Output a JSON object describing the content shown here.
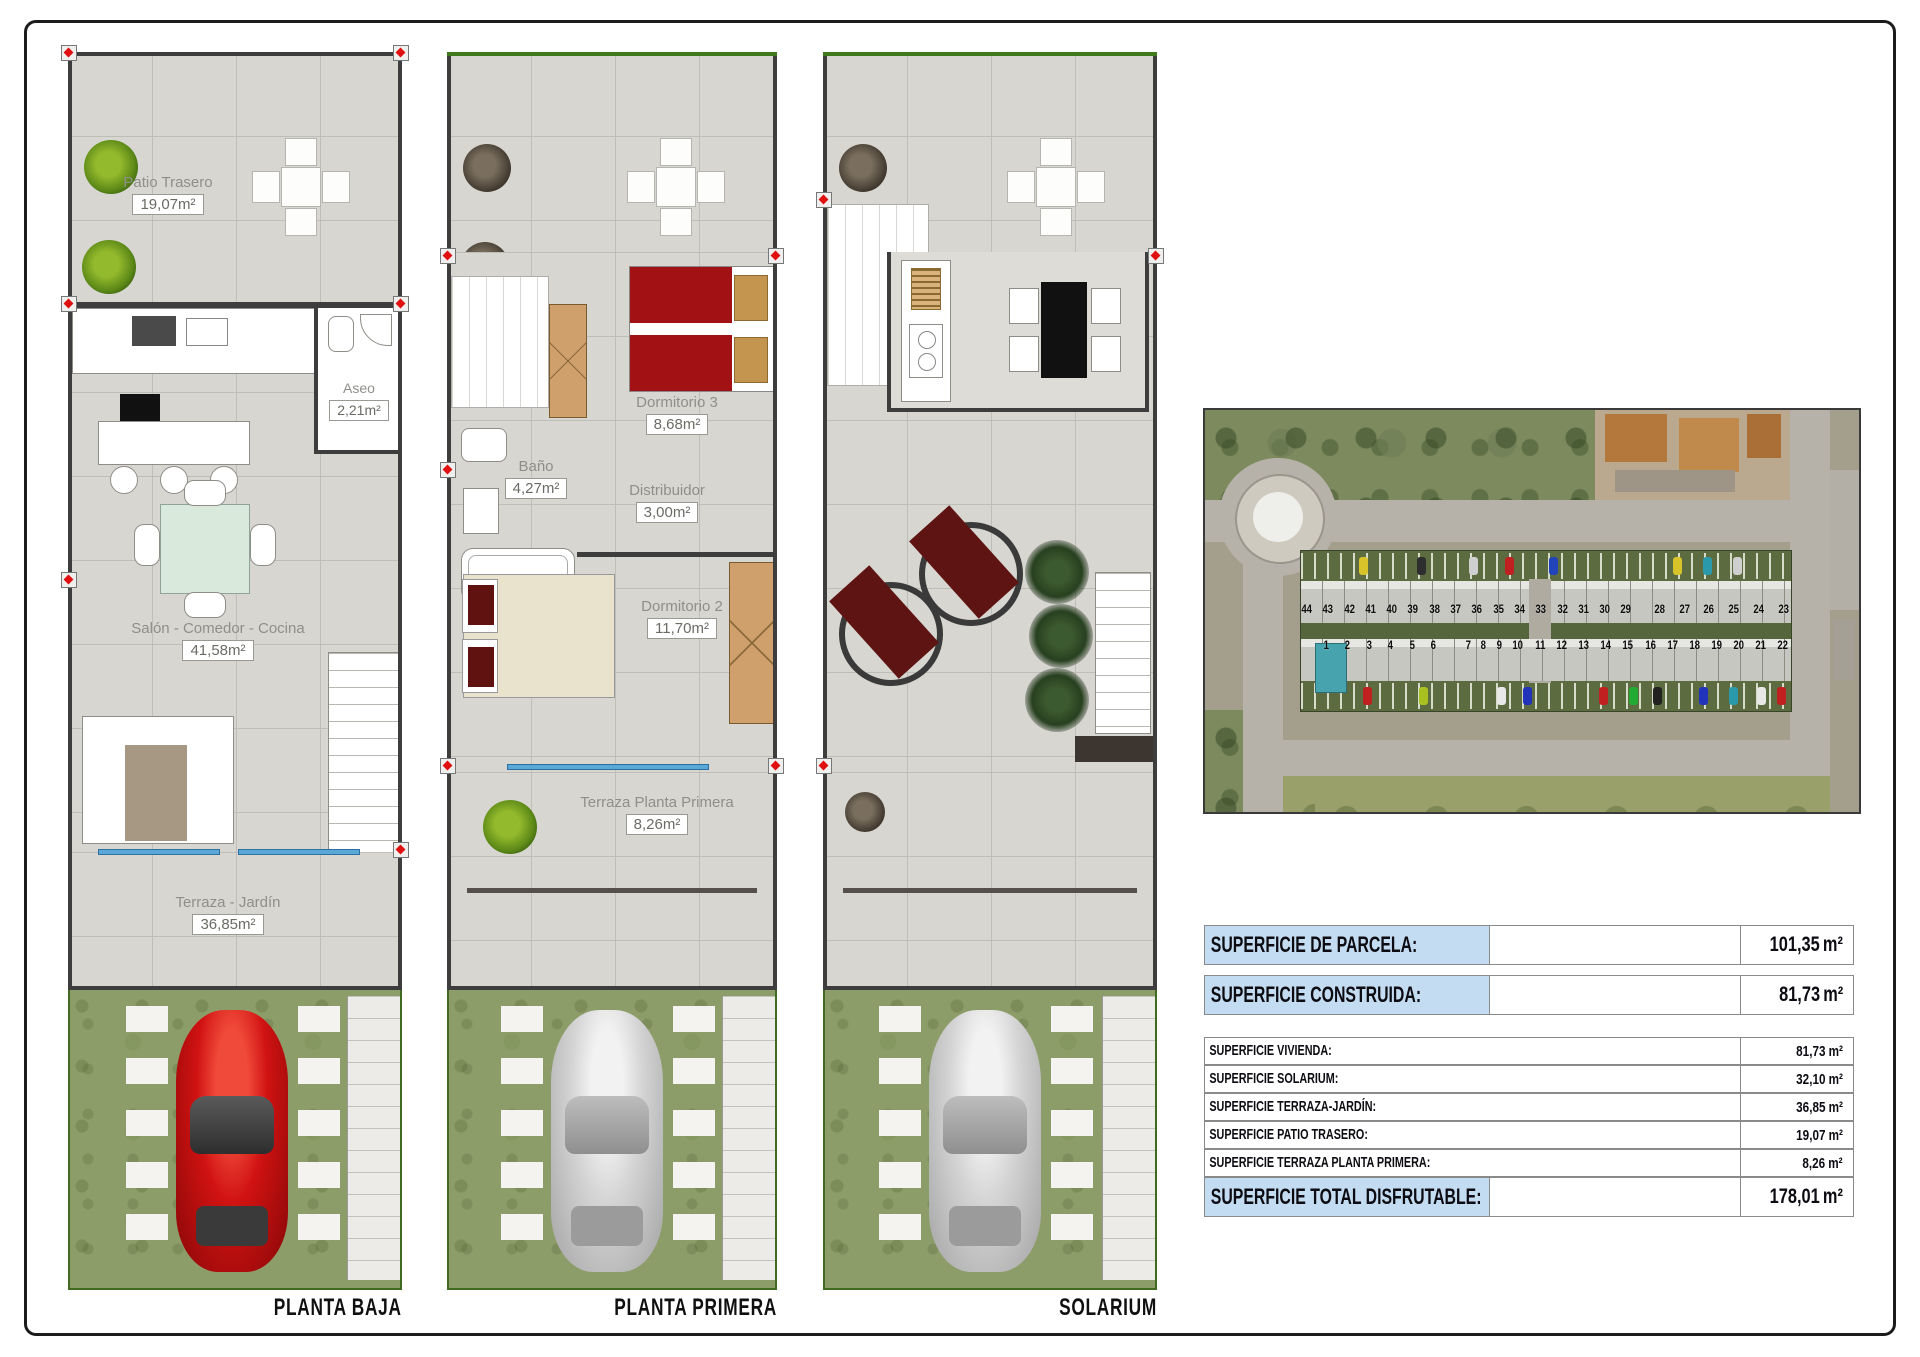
{
  "plans": [
    {
      "title": "PLANTA BAJA",
      "rooms": {
        "patio": {
          "name": "Patio Trasero",
          "area": "19,07"
        },
        "aseo": {
          "name": "Aseo",
          "area": "2,21"
        },
        "salon": {
          "name": "Salón - Comedor - Cocina",
          "area": "41,58"
        },
        "terraza": {
          "name": "Terraza - Jardín",
          "area": "36,85"
        }
      }
    },
    {
      "title": "PLANTA PRIMERA",
      "rooms": {
        "dorm3": {
          "name": "Dormitorio 3",
          "area": "8,68"
        },
        "bano": {
          "name": "Baño",
          "area": "4,27"
        },
        "distribuidor": {
          "name": "Distribuidor",
          "area": "3,00"
        },
        "dorm2": {
          "name": "Dormitorio 2",
          "area": "11,70"
        },
        "terraza": {
          "name": "Terraza Planta Primera",
          "area": "8,26"
        }
      }
    },
    {
      "title": "SOLARIUM",
      "rooms": {}
    }
  ],
  "units": {
    "sqm": "m²"
  },
  "site_plan": {
    "numbers_top_left": [
      "44",
      "43",
      "42",
      "41",
      "40",
      "39",
      "38",
      "37",
      "36",
      "35",
      "34",
      "33",
      "32",
      "31",
      "30",
      "29"
    ],
    "numbers_top_right": [
      "28",
      "27",
      "26",
      "25",
      "24",
      "23"
    ],
    "numbers_bottom_left": [
      "1",
      "2",
      "3",
      "4",
      "5",
      "6"
    ],
    "numbers_bottom_right": [
      "7",
      "8",
      "9",
      "10",
      "11",
      "12",
      "13",
      "14",
      "15",
      "16",
      "17",
      "18",
      "19",
      "20",
      "21",
      "22"
    ]
  },
  "table": {
    "rows": [
      {
        "label": "SUPERFICIE DE PARCELA:",
        "value": "101,35",
        "unit": "m²",
        "style": "highlight"
      },
      {
        "label": "SUPERFICIE CONSTRUIDA:",
        "value": "81,73",
        "unit": "m²",
        "style": "highlight"
      },
      {
        "label": "SUPERFICIE VIVIENDA:",
        "value": "81,73",
        "unit": "m²",
        "style": "detail"
      },
      {
        "label": "SUPERFICIE SOLARIUM:",
        "value": "32,10",
        "unit": "m²",
        "style": "detail"
      },
      {
        "label": "SUPERFICIE TERRAZA-JARDÍN:",
        "value": "36,85",
        "unit": "m²",
        "style": "detail"
      },
      {
        "label": "SUPERFICIE PATIO TRASERO:",
        "value": "19,07",
        "unit": "m²",
        "style": "detail"
      },
      {
        "label": "SUPERFICIE TERRAZA PLANTA PRIMERA:",
        "value": "8,26",
        "unit": "m²",
        "style": "detail"
      },
      {
        "label": "SUPERFICIE TOTAL DISFRUTABLE:",
        "value": "178,01",
        "unit": "m²",
        "style": "highlight"
      }
    ]
  },
  "colors": {
    "table_highlight": "#c4dcf2",
    "grass": "#8d9d6a",
    "tile_floor": "#d8d6d1",
    "car_red": "#d01212",
    "marker_red": "#e01010"
  }
}
